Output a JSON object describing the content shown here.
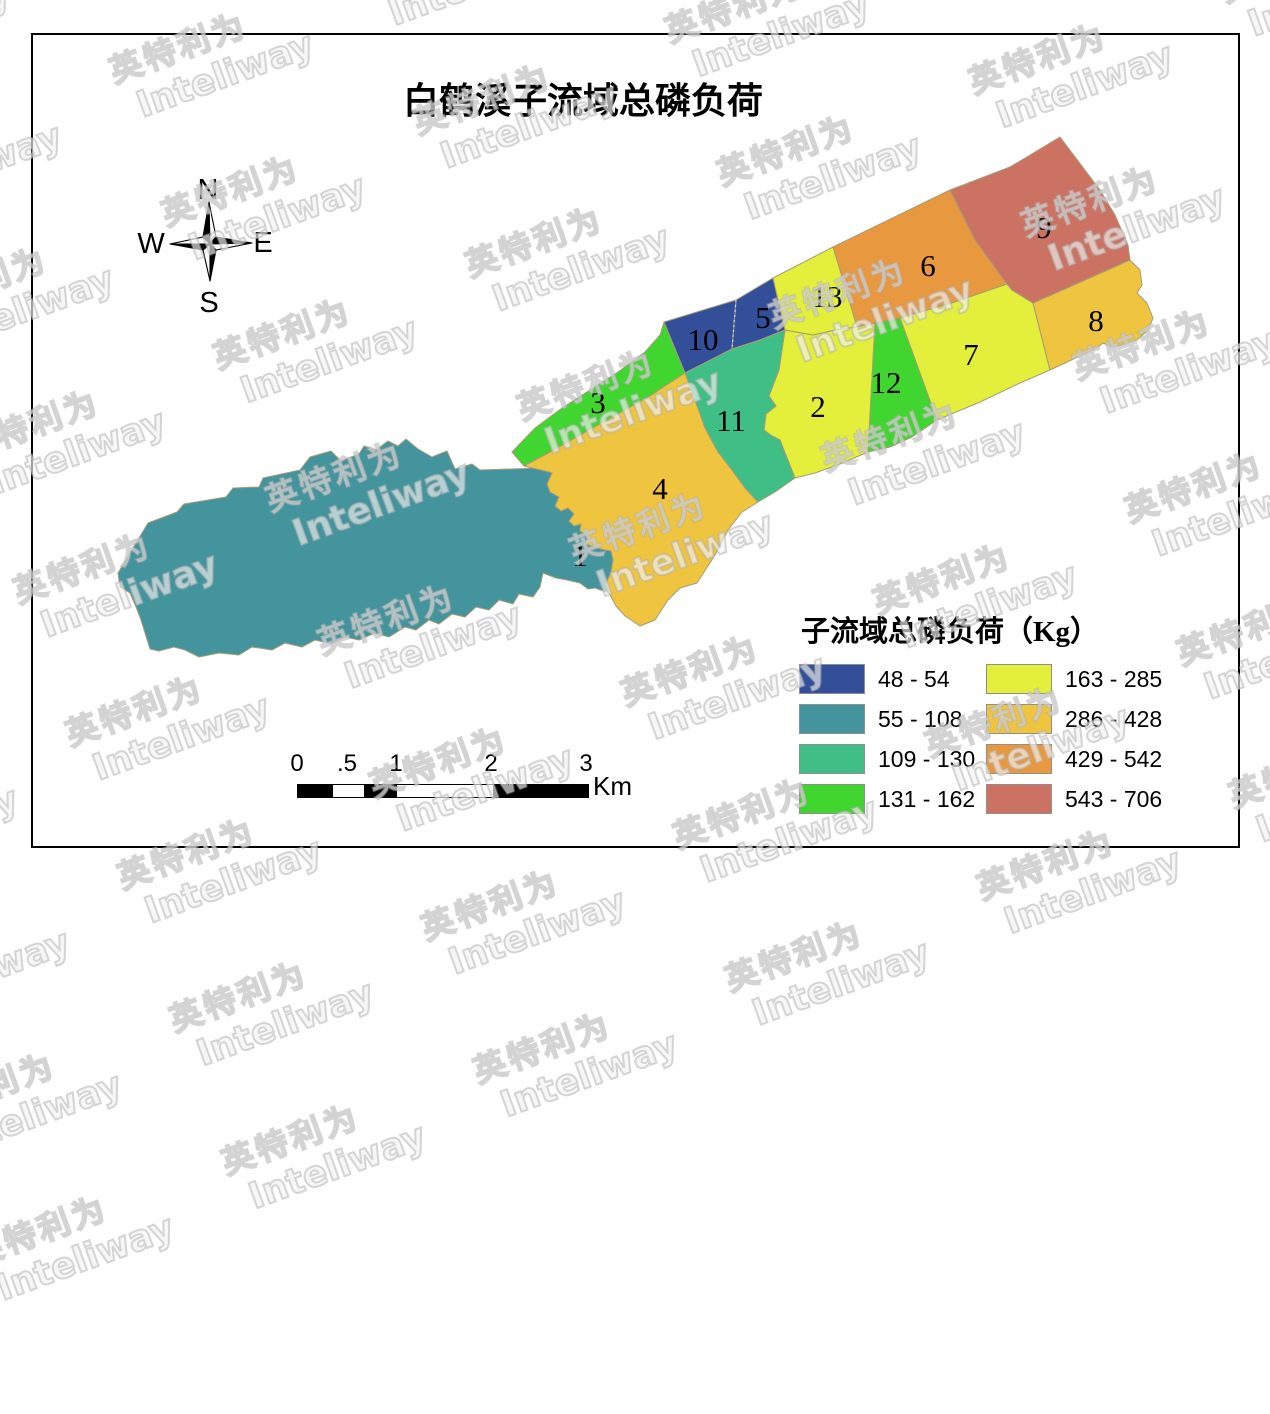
{
  "page": {
    "title": "白鹤溪子流域总磷负荷"
  },
  "compass": {
    "north": "N",
    "south": "S",
    "east": "E",
    "west": "W"
  },
  "watermark": {
    "line1": "英特利为",
    "line2": "Inteliway"
  },
  "map": {
    "regions": [
      {
        "id": "1",
        "label": "1",
        "class_index": 1
      },
      {
        "id": "2",
        "label": "2",
        "class_index": 4
      },
      {
        "id": "3",
        "label": "3",
        "class_index": 3
      },
      {
        "id": "4",
        "label": "4",
        "class_index": 5
      },
      {
        "id": "5",
        "label": "5",
        "class_index": 0
      },
      {
        "id": "6",
        "label": "6",
        "class_index": 6
      },
      {
        "id": "7",
        "label": "7",
        "class_index": 4
      },
      {
        "id": "8",
        "label": "8",
        "class_index": 5
      },
      {
        "id": "9",
        "label": "9",
        "class_index": 7
      },
      {
        "id": "10",
        "label": "10",
        "class_index": 0
      },
      {
        "id": "11",
        "label": "11",
        "class_index": 2
      },
      {
        "id": "12",
        "label": "12",
        "class_index": 3
      },
      {
        "id": "13",
        "label": "13",
        "class_index": 4
      }
    ]
  },
  "legend": {
    "title": "子流域总磷负荷（Kg）",
    "classes": [
      {
        "label": "48 - 54",
        "color": "#334F9A"
      },
      {
        "label": "55 - 108",
        "color": "#44949E"
      },
      {
        "label": "109 - 130",
        "color": "#3FBE85"
      },
      {
        "label": "131 - 162",
        "color": "#41D52F"
      },
      {
        "label": "163 - 285",
        "color": "#E3EF3B"
      },
      {
        "label": "286 - 428",
        "color": "#EFC43F"
      },
      {
        "label": "429 - 542",
        "color": "#E8993F"
      },
      {
        "label": "543 - 706",
        "color": "#CC7263"
      }
    ]
  },
  "scalebar": {
    "ticks": [
      "0",
      ".5",
      "1",
      "2",
      "3"
    ],
    "unit": "Km"
  }
}
